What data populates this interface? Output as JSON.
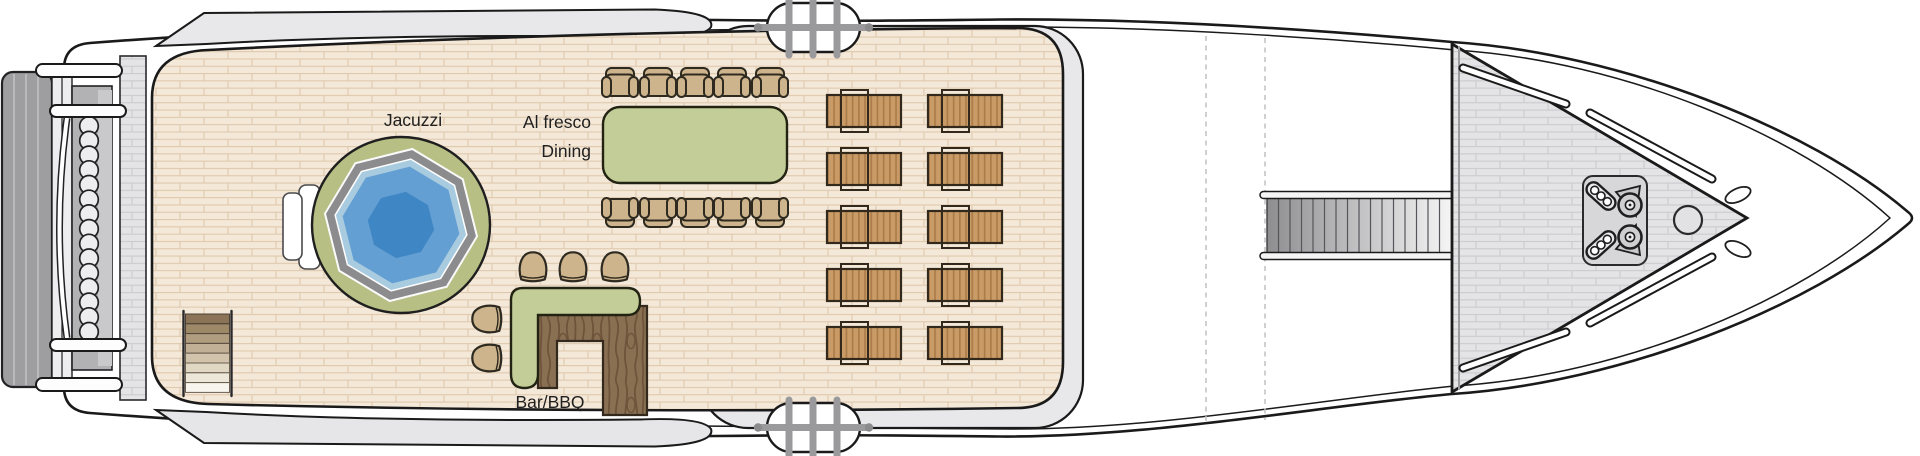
{
  "diagram": {
    "type": "yacht-sun-deck-plan",
    "labels": {
      "jacuzzi": "Jacuzzi",
      "dining_line1": "Al fresco",
      "dining_line2": "Dining",
      "bar": "Bar/BBQ"
    },
    "features": [
      {
        "name": "jacuzzi",
        "label": "Jacuzzi"
      },
      {
        "name": "al-fresco-dining",
        "label": "Al fresco Dining",
        "chairs": 10
      },
      {
        "name": "bar-bbq",
        "label": "Bar/BBQ",
        "stools": 5
      },
      {
        "name": "sun-loungers",
        "count": 10,
        "columns": 2,
        "rows": 5
      },
      {
        "name": "deck-stairs",
        "steps": 8
      },
      {
        "name": "foredeck-staircase",
        "treads": 16
      },
      {
        "name": "boarding-gates",
        "count": 2,
        "bars_per_gate": 3
      },
      {
        "name": "stern-fenders",
        "count": 15
      },
      {
        "name": "anchor-winches",
        "count": 2
      },
      {
        "name": "hawse-holes",
        "count": 2
      }
    ],
    "colors": {
      "outline": "#1a1a1a",
      "deck_plank": "#f4e8d8",
      "deck_plank_line": "#dfc9ae",
      "hull_white": "#ffffff",
      "superstructure_gray": "#e8e8ea",
      "foredeck_gray": "#e4e4e6",
      "furniture_green": "#c3cd97",
      "jacuzzi_surround_green": "#b7bf85",
      "jacuzzi_rim_gray": "#8c8c8e",
      "jacuzzi_water_light": "#a9cbdf",
      "jacuzzi_water_mid": "#639fd3",
      "jacuzzi_water_deep": "#3f86c5",
      "chair_tan": "#cdb48c",
      "lounger_wood": "#c99b66",
      "lounger_wood_dark": "#ab7c49",
      "bar_wood": "#8a7053",
      "rail_gray": "#9a9a9c",
      "stern_platform_gray": "#9e9ea0"
    }
  }
}
